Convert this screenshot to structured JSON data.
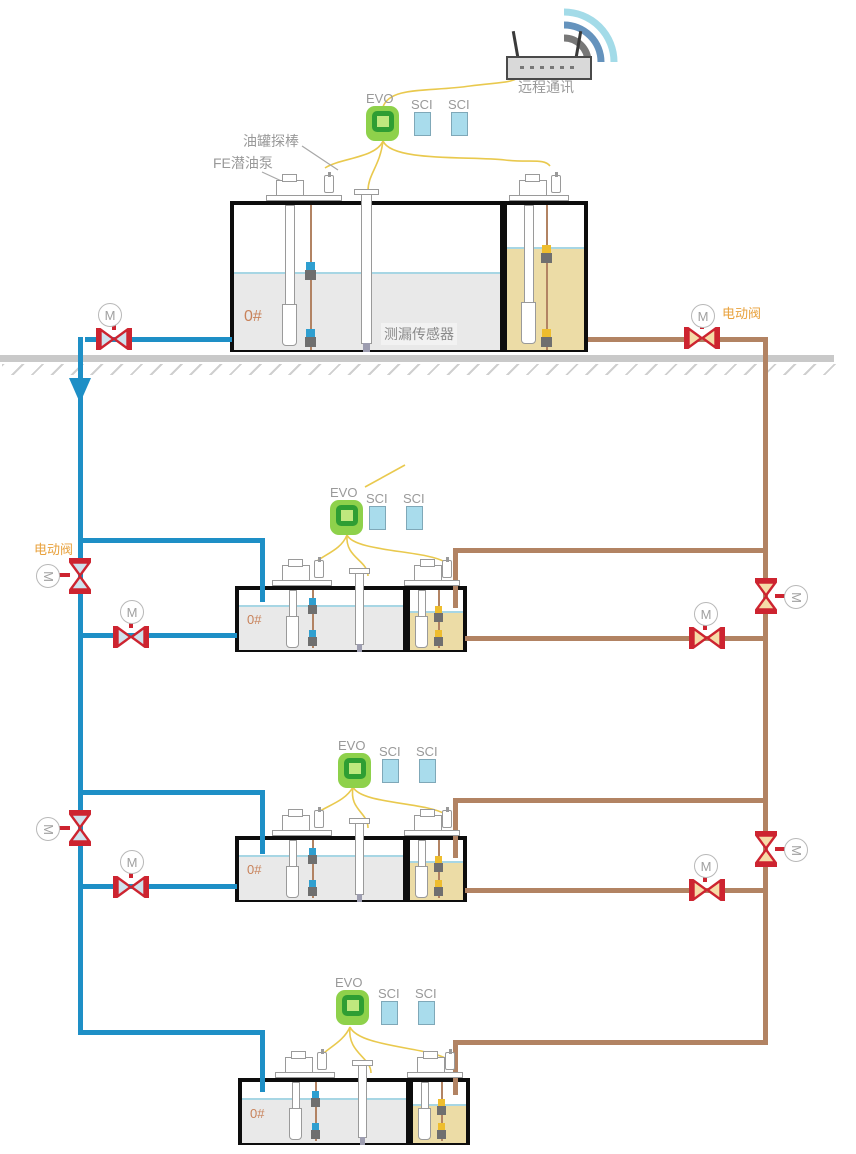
{
  "labels": {
    "remote_comm": "远程通讯",
    "evo": "EVO",
    "sci": "SCI",
    "tank_probe": "油罐探棒",
    "fe_pump": "FE潜油泵",
    "leak_sensor": "测漏传感器",
    "electric_valve": "电动阀",
    "motor": "M"
  },
  "tiers": [
    {
      "grade": "0#"
    },
    {
      "grade": "0#"
    },
    {
      "grade": "0#"
    },
    {
      "grade": "0#"
    }
  ],
  "colors": {
    "pipe_blue": "#1e8fc6",
    "pipe_brown": "#b28363",
    "valve_red": "#cd2430",
    "valve_fill_blue": "#cfe3ee",
    "valve_fill_brown": "#f6dca8",
    "evo_green": "#8ed14b",
    "evo_ring": "#2f9e33",
    "sci_blue": "#a9dcec",
    "liquid_gray": "#e9e9e9",
    "liquid_tan": "#ecdca6",
    "waterline": "#a7d6e4",
    "wire_yellow": "#e9c94e",
    "label_gray": "#999999",
    "label_orange": "#e8a13c",
    "grade_orange": "#c8825a",
    "ground_gray": "#c9c9c9"
  }
}
